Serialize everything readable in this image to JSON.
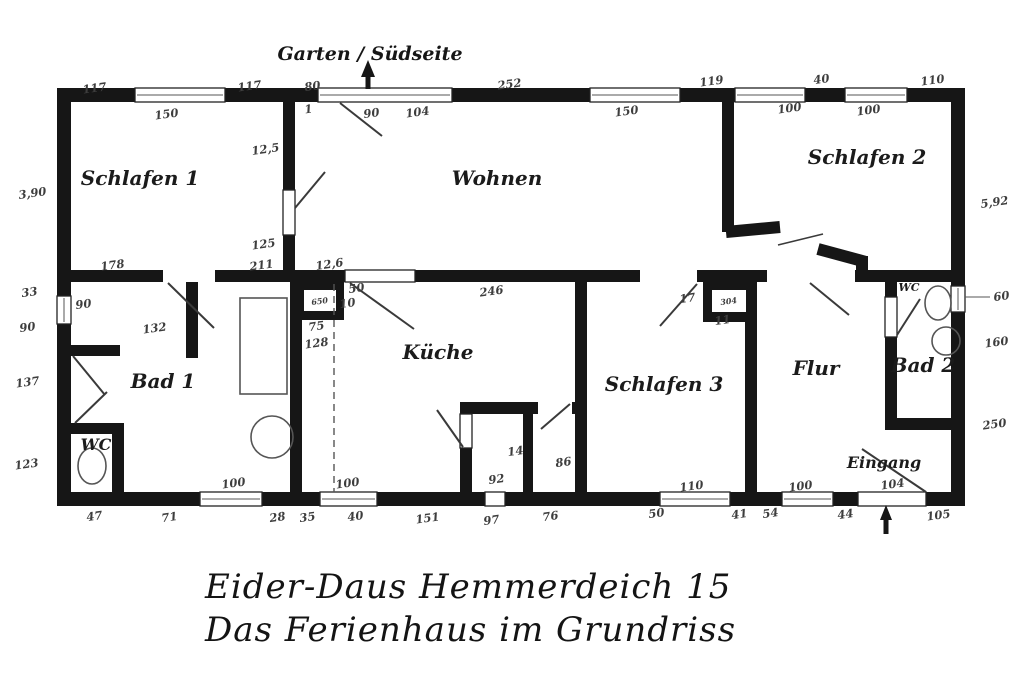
{
  "title": {
    "line1": "Eider-Daus  Hemmerdeich 15",
    "line2": "Das Ferienhaus im Grundriss"
  },
  "colors": {
    "wall": "#161616",
    "line": "#3a3a3a",
    "background": "#ffffff"
  },
  "labels": [
    {
      "t": "Schlafen 1",
      "k": "room",
      "x": 140,
      "y": 185
    },
    {
      "t": "Wohnen",
      "k": "room",
      "x": 497,
      "y": 185
    },
    {
      "t": "Schlafen 2",
      "k": "room",
      "x": 867,
      "y": 164
    },
    {
      "t": "Bad 1",
      "k": "room",
      "x": 163,
      "y": 388
    },
    {
      "t": "Küche",
      "k": "room",
      "x": 438,
      "y": 359
    },
    {
      "t": "Schlafen 3",
      "k": "room",
      "x": 664,
      "y": 391
    },
    {
      "t": "Flur",
      "k": "room",
      "x": 816,
      "y": 375
    },
    {
      "t": "Bad 2",
      "k": "room",
      "x": 923,
      "y": 372
    },
    {
      "t": "WC",
      "k": "room-sm",
      "x": 96,
      "y": 450
    },
    {
      "t": "WC",
      "k": "room-xs",
      "x": 909,
      "y": 291
    },
    {
      "t": "Garten / Südseite",
      "k": "annotation",
      "x": 370,
      "y": 60
    },
    {
      "t": "Eingang",
      "k": "room-sm",
      "x": 884,
      "y": 468
    },
    {
      "t": "117",
      "k": "dim",
      "x": 95,
      "y": 92
    },
    {
      "t": "117",
      "k": "dim",
      "x": 250,
      "y": 90
    },
    {
      "t": "80",
      "k": "dim",
      "x": 313,
      "y": 90
    },
    {
      "t": "252",
      "k": "dim",
      "x": 510,
      "y": 88
    },
    {
      "t": "119",
      "k": "dim",
      "x": 712,
      "y": 85
    },
    {
      "t": "40",
      "k": "dim",
      "x": 822,
      "y": 83
    },
    {
      "t": "110",
      "k": "dim",
      "x": 933,
      "y": 84
    },
    {
      "t": "150",
      "k": "dim",
      "x": 167,
      "y": 118
    },
    {
      "t": "1",
      "k": "dim",
      "x": 309,
      "y": 113
    },
    {
      "t": "90",
      "k": "dim",
      "x": 372,
      "y": 117
    },
    {
      "t": "104",
      "k": "dim",
      "x": 418,
      "y": 116
    },
    {
      "t": "150",
      "k": "dim",
      "x": 627,
      "y": 115
    },
    {
      "t": "100",
      "k": "dim",
      "x": 790,
      "y": 112
    },
    {
      "t": "100",
      "k": "dim",
      "x": 869,
      "y": 114
    },
    {
      "t": "3,90",
      "k": "dim",
      "x": 33,
      "y": 197
    },
    {
      "t": "33",
      "k": "dim",
      "x": 30,
      "y": 296
    },
    {
      "t": "90",
      "k": "dim",
      "x": 28,
      "y": 331
    },
    {
      "t": "137",
      "k": "dim",
      "x": 28,
      "y": 386
    },
    {
      "t": "123",
      "k": "dim",
      "x": 27,
      "y": 468
    },
    {
      "t": "5,92",
      "k": "dim",
      "x": 995,
      "y": 206
    },
    {
      "t": "60",
      "k": "dim",
      "x": 1002,
      "y": 300
    },
    {
      "t": "160",
      "k": "dim",
      "x": 997,
      "y": 346
    },
    {
      "t": "250",
      "k": "dim",
      "x": 995,
      "y": 428
    },
    {
      "t": "12,5",
      "k": "dim",
      "x": 266,
      "y": 153
    },
    {
      "t": "125",
      "k": "dim",
      "x": 264,
      "y": 248
    },
    {
      "t": "178",
      "k": "dim",
      "x": 113,
      "y": 269
    },
    {
      "t": "211",
      "k": "dim",
      "x": 262,
      "y": 269
    },
    {
      "t": "12,6",
      "k": "dim",
      "x": 330,
      "y": 268
    },
    {
      "t": "132",
      "k": "dim",
      "x": 155,
      "y": 332
    },
    {
      "t": "90",
      "k": "dim",
      "x": 84,
      "y": 308
    },
    {
      "t": "50",
      "k": "dim",
      "x": 357,
      "y": 292
    },
    {
      "t": "10",
      "k": "dim",
      "x": 348,
      "y": 307
    },
    {
      "t": "246",
      "k": "dim",
      "x": 492,
      "y": 295
    },
    {
      "t": "75",
      "k": "dim",
      "x": 317,
      "y": 330
    },
    {
      "t": "128",
      "k": "dim",
      "x": 317,
      "y": 347
    },
    {
      "t": "17",
      "k": "dim",
      "x": 688,
      "y": 302
    },
    {
      "t": "11",
      "k": "dim",
      "x": 723,
      "y": 324
    },
    {
      "t": "14",
      "k": "dim",
      "x": 516,
      "y": 455
    },
    {
      "t": "86",
      "k": "dim",
      "x": 564,
      "y": 466
    },
    {
      "t": "92",
      "k": "dim",
      "x": 497,
      "y": 483
    },
    {
      "t": "110",
      "k": "dim",
      "x": 692,
      "y": 490
    },
    {
      "t": "100",
      "k": "dim",
      "x": 801,
      "y": 490
    },
    {
      "t": "104",
      "k": "dim",
      "x": 893,
      "y": 488
    },
    {
      "t": "100",
      "k": "dim",
      "x": 234,
      "y": 487
    },
    {
      "t": "100",
      "k": "dim",
      "x": 348,
      "y": 487
    },
    {
      "t": "47",
      "k": "dim",
      "x": 95,
      "y": 520
    },
    {
      "t": "71",
      "k": "dim",
      "x": 170,
      "y": 521
    },
    {
      "t": "28",
      "k": "dim",
      "x": 278,
      "y": 521
    },
    {
      "t": "35",
      "k": "dim",
      "x": 308,
      "y": 521
    },
    {
      "t": "40",
      "k": "dim",
      "x": 356,
      "y": 520
    },
    {
      "t": "151",
      "k": "dim",
      "x": 428,
      "y": 522
    },
    {
      "t": "97",
      "k": "dim",
      "x": 492,
      "y": 524
    },
    {
      "t": "76",
      "k": "dim",
      "x": 551,
      "y": 520
    },
    {
      "t": "50",
      "k": "dim",
      "x": 657,
      "y": 517
    },
    {
      "t": "41",
      "k": "dim",
      "x": 740,
      "y": 518
    },
    {
      "t": "54",
      "k": "dim",
      "x": 771,
      "y": 517
    },
    {
      "t": "44",
      "k": "dim",
      "x": 846,
      "y": 518
    },
    {
      "t": "105",
      "k": "dim",
      "x": 939,
      "y": 519
    },
    {
      "t": "650",
      "k": "tiny",
      "x": 320,
      "y": 304
    },
    {
      "t": "304",
      "k": "tiny",
      "x": 729,
      "y": 304
    }
  ]
}
